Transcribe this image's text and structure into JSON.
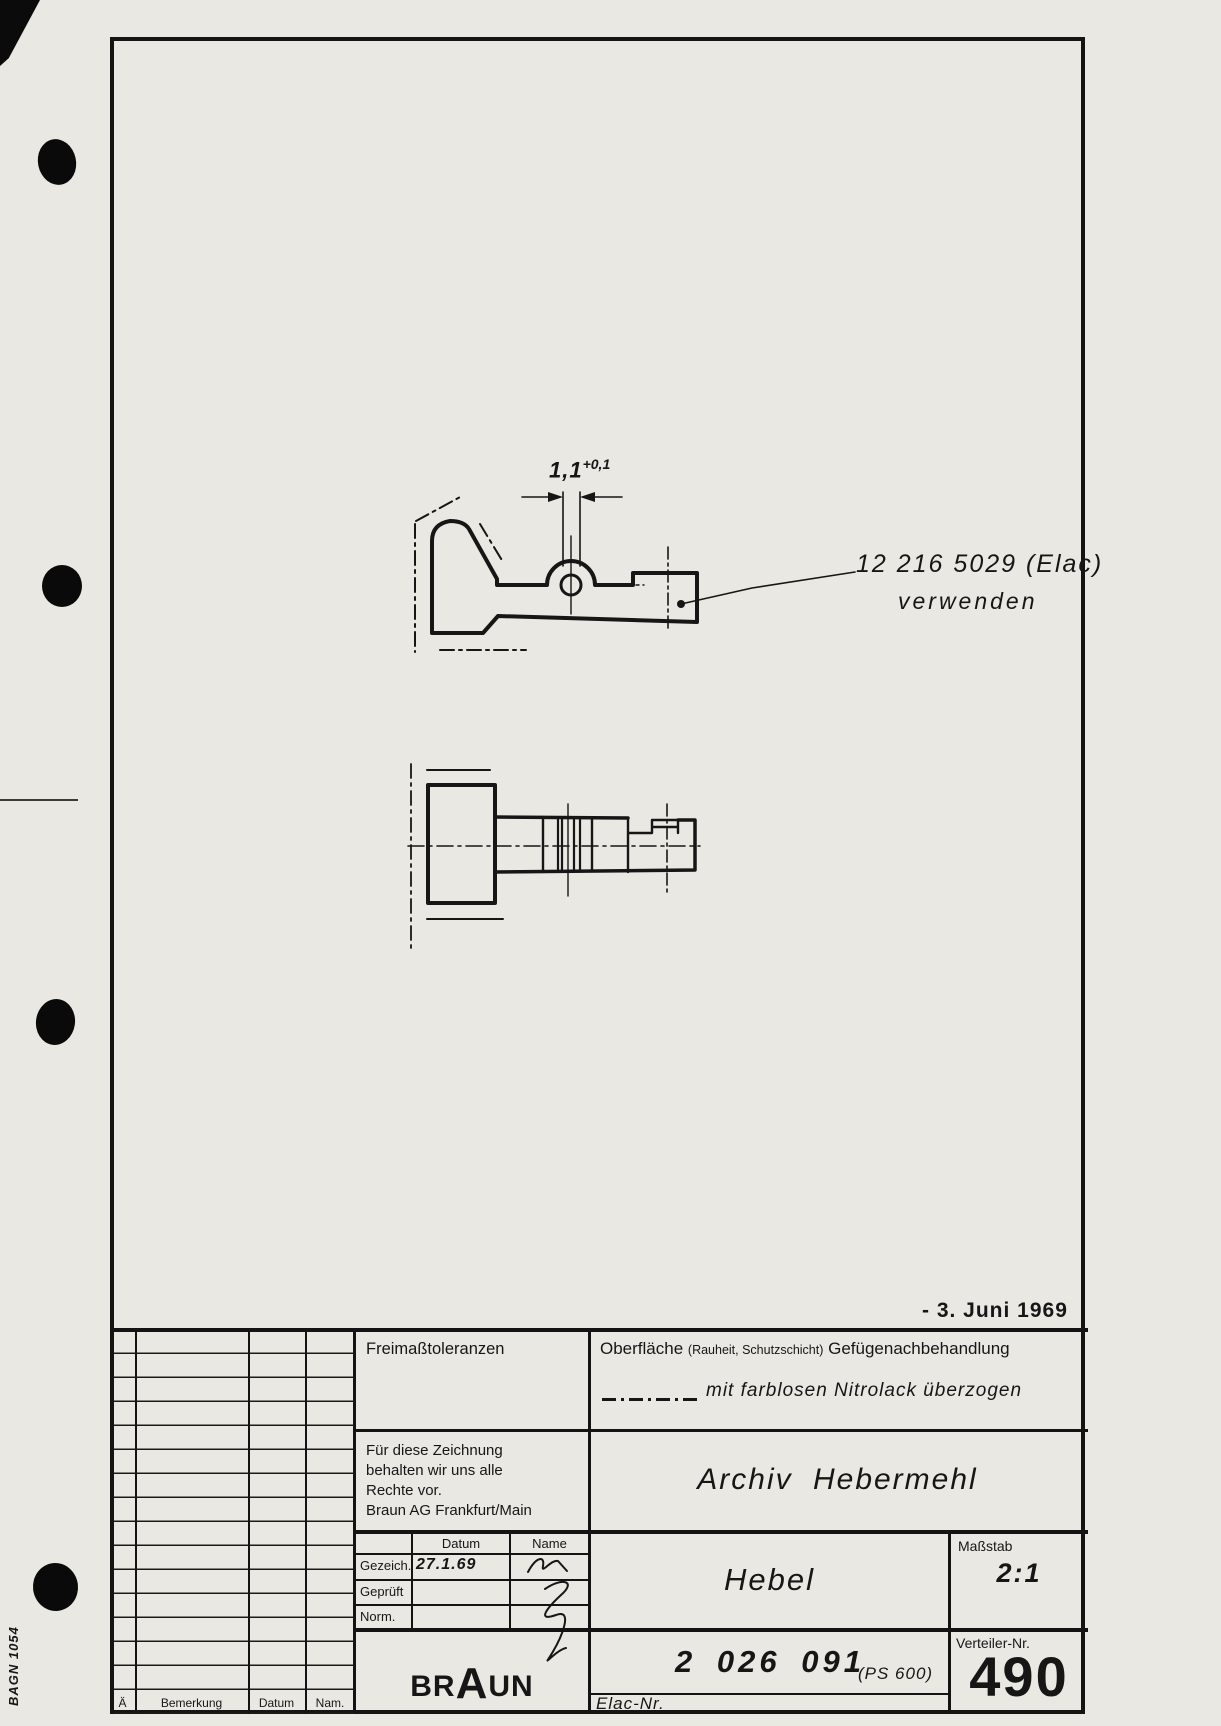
{
  "margin": {
    "form_code": "BAGN 1054"
  },
  "drawing": {
    "dimension_value": "1,1",
    "dimension_tolerance": "+0,1",
    "leader_note_line1": "12 216 5029 (Elac)",
    "leader_note_line2": "verwenden",
    "date_stamp": "- 3. Juni 1969"
  },
  "title_block": {
    "freimass_label": "Freimaßtoleranzen",
    "surface_label": "Oberfläche",
    "surface_label_paren": "(Rauheit, Schutzschicht)",
    "surface_label2": "Gefügenachbehandlung",
    "surface_value": "mit farblosen Nitrolack überzogen",
    "rights_note": [
      "Für diese Zeichnung",
      "behalten wir uns alle",
      "Rechte vor.",
      "Braun AG Frankfurt/Main"
    ],
    "archive_name": "Archiv Hebermehl",
    "approval": {
      "datum_header": "Datum",
      "name_header": "Name",
      "rows": [
        {
          "label": "Gezeich.",
          "date": "27.1.69"
        },
        {
          "label": "Geprüft",
          "date": ""
        },
        {
          "label": "Norm.",
          "date": ""
        }
      ]
    },
    "part_name": "Hebel",
    "scale_label": "Maßstab",
    "scale_value": "2:1",
    "brand_parts": [
      "BR",
      "A",
      "UN"
    ],
    "drawing_number": "2 026 091",
    "drawing_number_suffix": "(PS 600)",
    "elac_label": "Elac-Nr.",
    "distributor_label": "Verteiler-Nr.",
    "distributor_value": "490",
    "revision_columns": {
      "a": "Ä",
      "remark": "Bemerkung",
      "date": "Datum",
      "name": "Nam."
    }
  }
}
